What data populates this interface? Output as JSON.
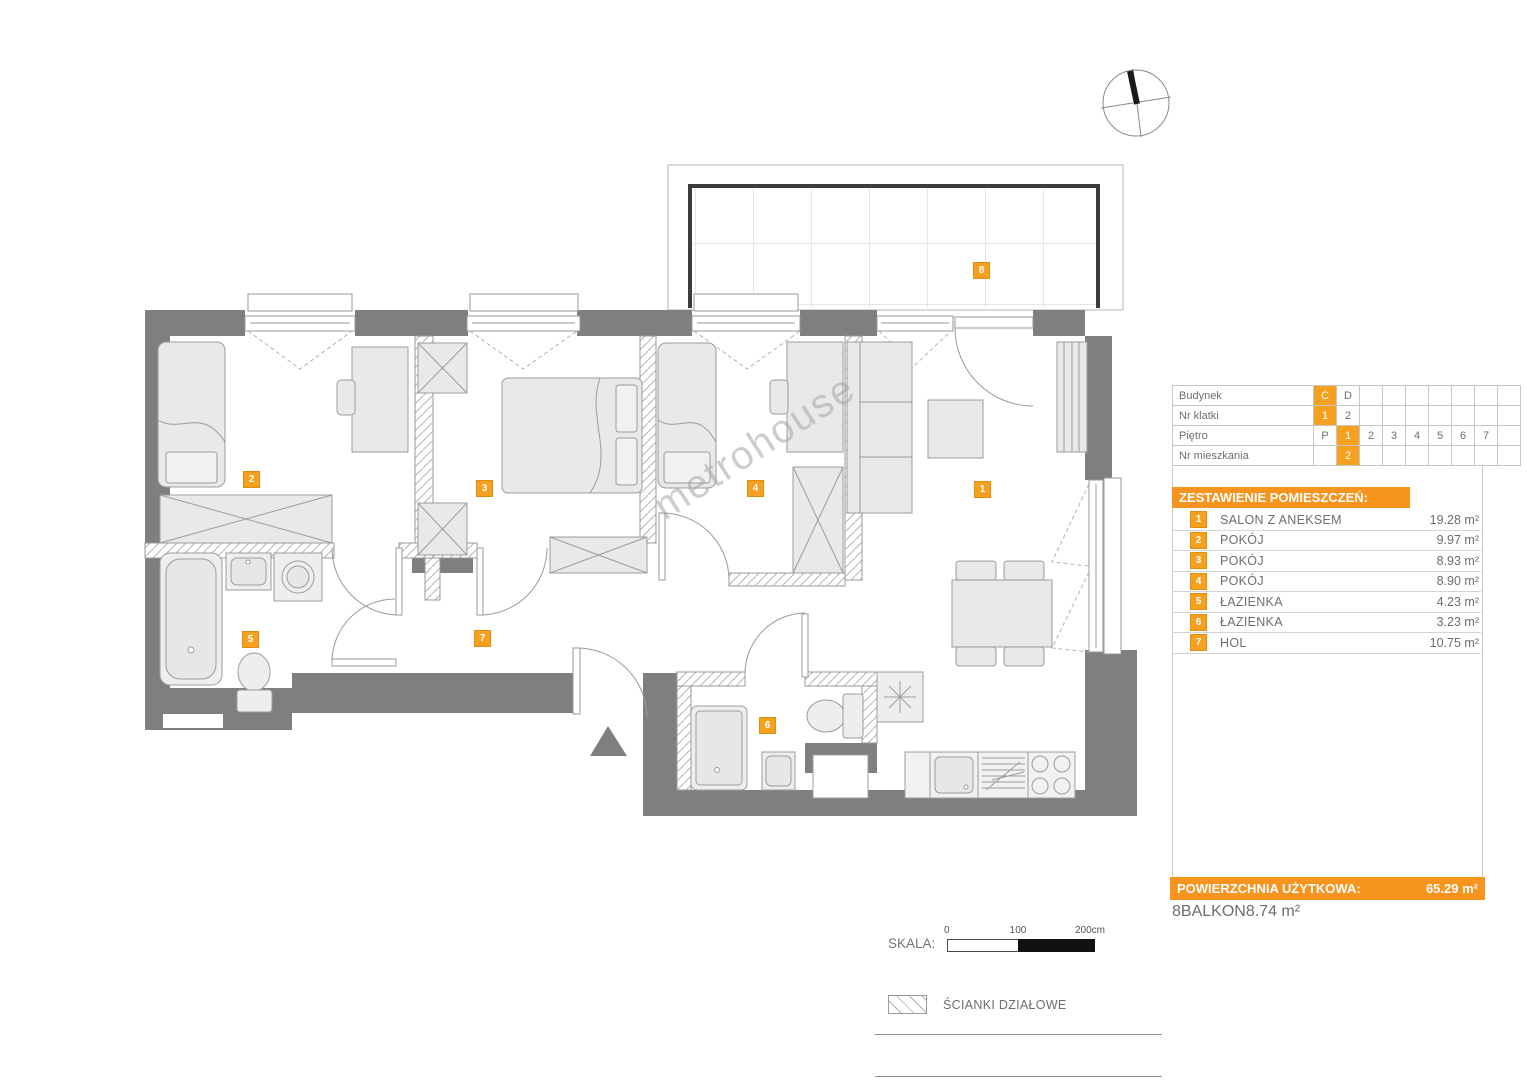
{
  "colors": {
    "accent_badge": "#f5a01f",
    "accent_bar": "#f7941e",
    "wall_gray": "#7f7f7f"
  },
  "plan": {
    "watermark": "metrohouse",
    "badges": [
      "1",
      "2",
      "3",
      "4",
      "5",
      "6",
      "7",
      "8"
    ]
  },
  "info_table": {
    "rows": [
      {
        "label": "Budynek",
        "cells": [
          {
            "t": "C"
          },
          {
            "t": "D"
          },
          {
            "t": ""
          },
          {
            "t": ""
          },
          {
            "t": ""
          },
          {
            "t": ""
          },
          {
            "t": ""
          },
          {
            "t": ""
          },
          {
            "t": ""
          }
        ]
      },
      {
        "label": "Nr klatki",
        "cells": [
          {
            "t": "1"
          },
          {
            "t": "2"
          },
          {
            "t": ""
          },
          {
            "t": ""
          },
          {
            "t": ""
          },
          {
            "t": ""
          },
          {
            "t": ""
          },
          {
            "t": ""
          },
          {
            "t": ""
          }
        ]
      },
      {
        "label": "Piętro",
        "cells": [
          {
            "t": "P"
          },
          {
            "t": "1"
          },
          {
            "t": "2"
          },
          {
            "t": "3"
          },
          {
            "t": "4"
          },
          {
            "t": "5"
          },
          {
            "t": "6"
          },
          {
            "t": "7"
          },
          {
            "t": ""
          }
        ]
      },
      {
        "label": "Nr mieszkania",
        "cells": [
          {
            "t": ""
          },
          {
            "t": "2"
          },
          {
            "t": ""
          },
          {
            "t": ""
          },
          {
            "t": ""
          },
          {
            "t": ""
          },
          {
            "t": ""
          },
          {
            "t": ""
          },
          {
            "t": ""
          }
        ]
      }
    ]
  },
  "legend": {
    "title": "ZESTAWIENIE POMIESZCZEŃ:",
    "rooms": [
      {
        "no": "1",
        "name": "SALON Z ANEKSEM",
        "area": "19.28 m²"
      },
      {
        "no": "2",
        "name": "POKÓJ",
        "area": "9.97 m²"
      },
      {
        "no": "3",
        "name": "POKÓJ",
        "area": "8.93 m²"
      },
      {
        "no": "4",
        "name": "POKÓJ",
        "area": "8.90 m²"
      },
      {
        "no": "5",
        "name": "ŁAZIENKA",
        "area": "4.23 m²"
      },
      {
        "no": "6",
        "name": "ŁAZIENKA",
        "area": "3.23 m²"
      },
      {
        "no": "7",
        "name": "HOL",
        "area": "10.75 m²"
      }
    ],
    "total_label": "POWIERZCHNIA UŻYTKOWA:",
    "total_value": "65.29 m²",
    "balcony": {
      "no": "8",
      "name": "BALKON",
      "area": "8.74 m²"
    }
  },
  "scale_bar": {
    "label": "SKALA:",
    "tick0": "0",
    "tick100": "100",
    "tick200": "200cm"
  },
  "partitions_legend": {
    "label": "ŚCIANKI DZIAŁOWE"
  }
}
